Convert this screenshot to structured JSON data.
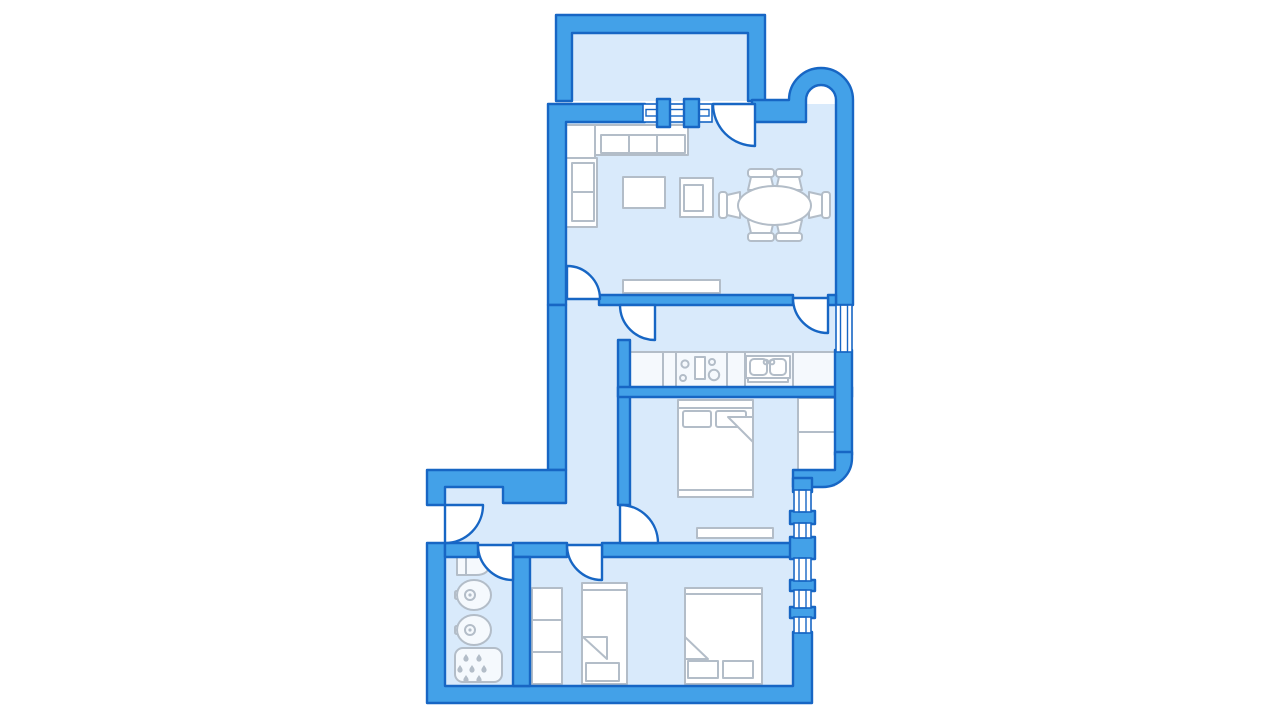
{
  "document": {
    "kind": "apartment-floor-plan",
    "style": "blue monochrome architectural drawing",
    "background": "#ffffff"
  },
  "colors": {
    "wall": "#43a1e8",
    "wallStroke": "#1766c4",
    "floor": "#d9eafb",
    "furnFill": "#ffffff",
    "furnStroke": "#b3bdc8",
    "fixtureFill": "#f5f9fd"
  },
  "rooms": [
    {
      "name": "balcony",
      "items": []
    },
    {
      "name": "living-room",
      "items": [
        "corner-sofa",
        "coffee-table",
        "armchair",
        "oval-dining-table",
        "six-dining-chairs",
        "radiator",
        "balcony-door",
        "balcony-window"
      ]
    },
    {
      "name": "kitchen",
      "items": [
        "counter-run",
        "cooktop-four-burners",
        "double-sink",
        "window-east"
      ]
    },
    {
      "name": "bedroom-master",
      "items": [
        "double-bed-two-pillows",
        "wardrobe-two-section",
        "radiator",
        "rounded-corner-wall"
      ]
    },
    {
      "name": "corridor-hall",
      "items": [
        "entrance-door",
        "step-wall"
      ]
    },
    {
      "name": "bathroom",
      "items": [
        "toilet",
        "washbasin",
        "washbasin",
        "shower-tray-with-drops"
      ]
    },
    {
      "name": "kids-room",
      "items": [
        "wardrobe-three-section",
        "single-bed",
        "double-bed-two-pillows",
        "window-strip-east"
      ]
    }
  ],
  "doors_count": 8,
  "windows_count": 7
}
